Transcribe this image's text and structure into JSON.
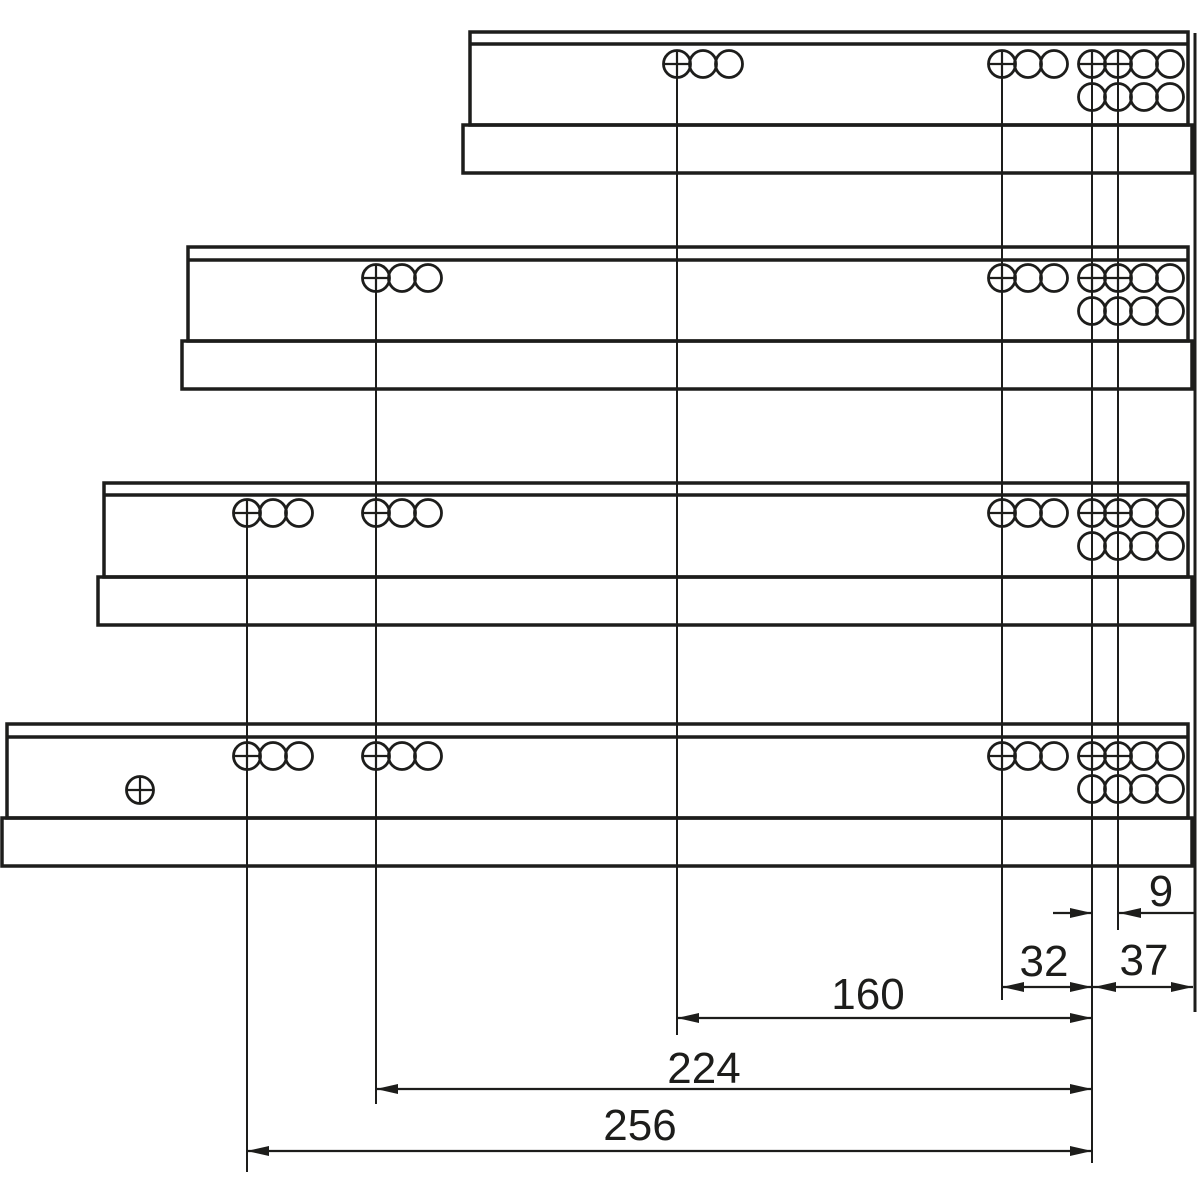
{
  "colors": {
    "ink": "#1d1d1b",
    "background": "#ffffff"
  },
  "diagram": {
    "description": "Technical drawing: four drawer runners of increasing length with drilling hole positions and dimension lines",
    "dimensions": {
      "d9": {
        "label": "9"
      },
      "d32": {
        "label": "32"
      },
      "d37": {
        "label": "37"
      },
      "d160": {
        "label": "160"
      },
      "d224": {
        "label": "224"
      },
      "d256": {
        "label": "256"
      }
    }
  }
}
